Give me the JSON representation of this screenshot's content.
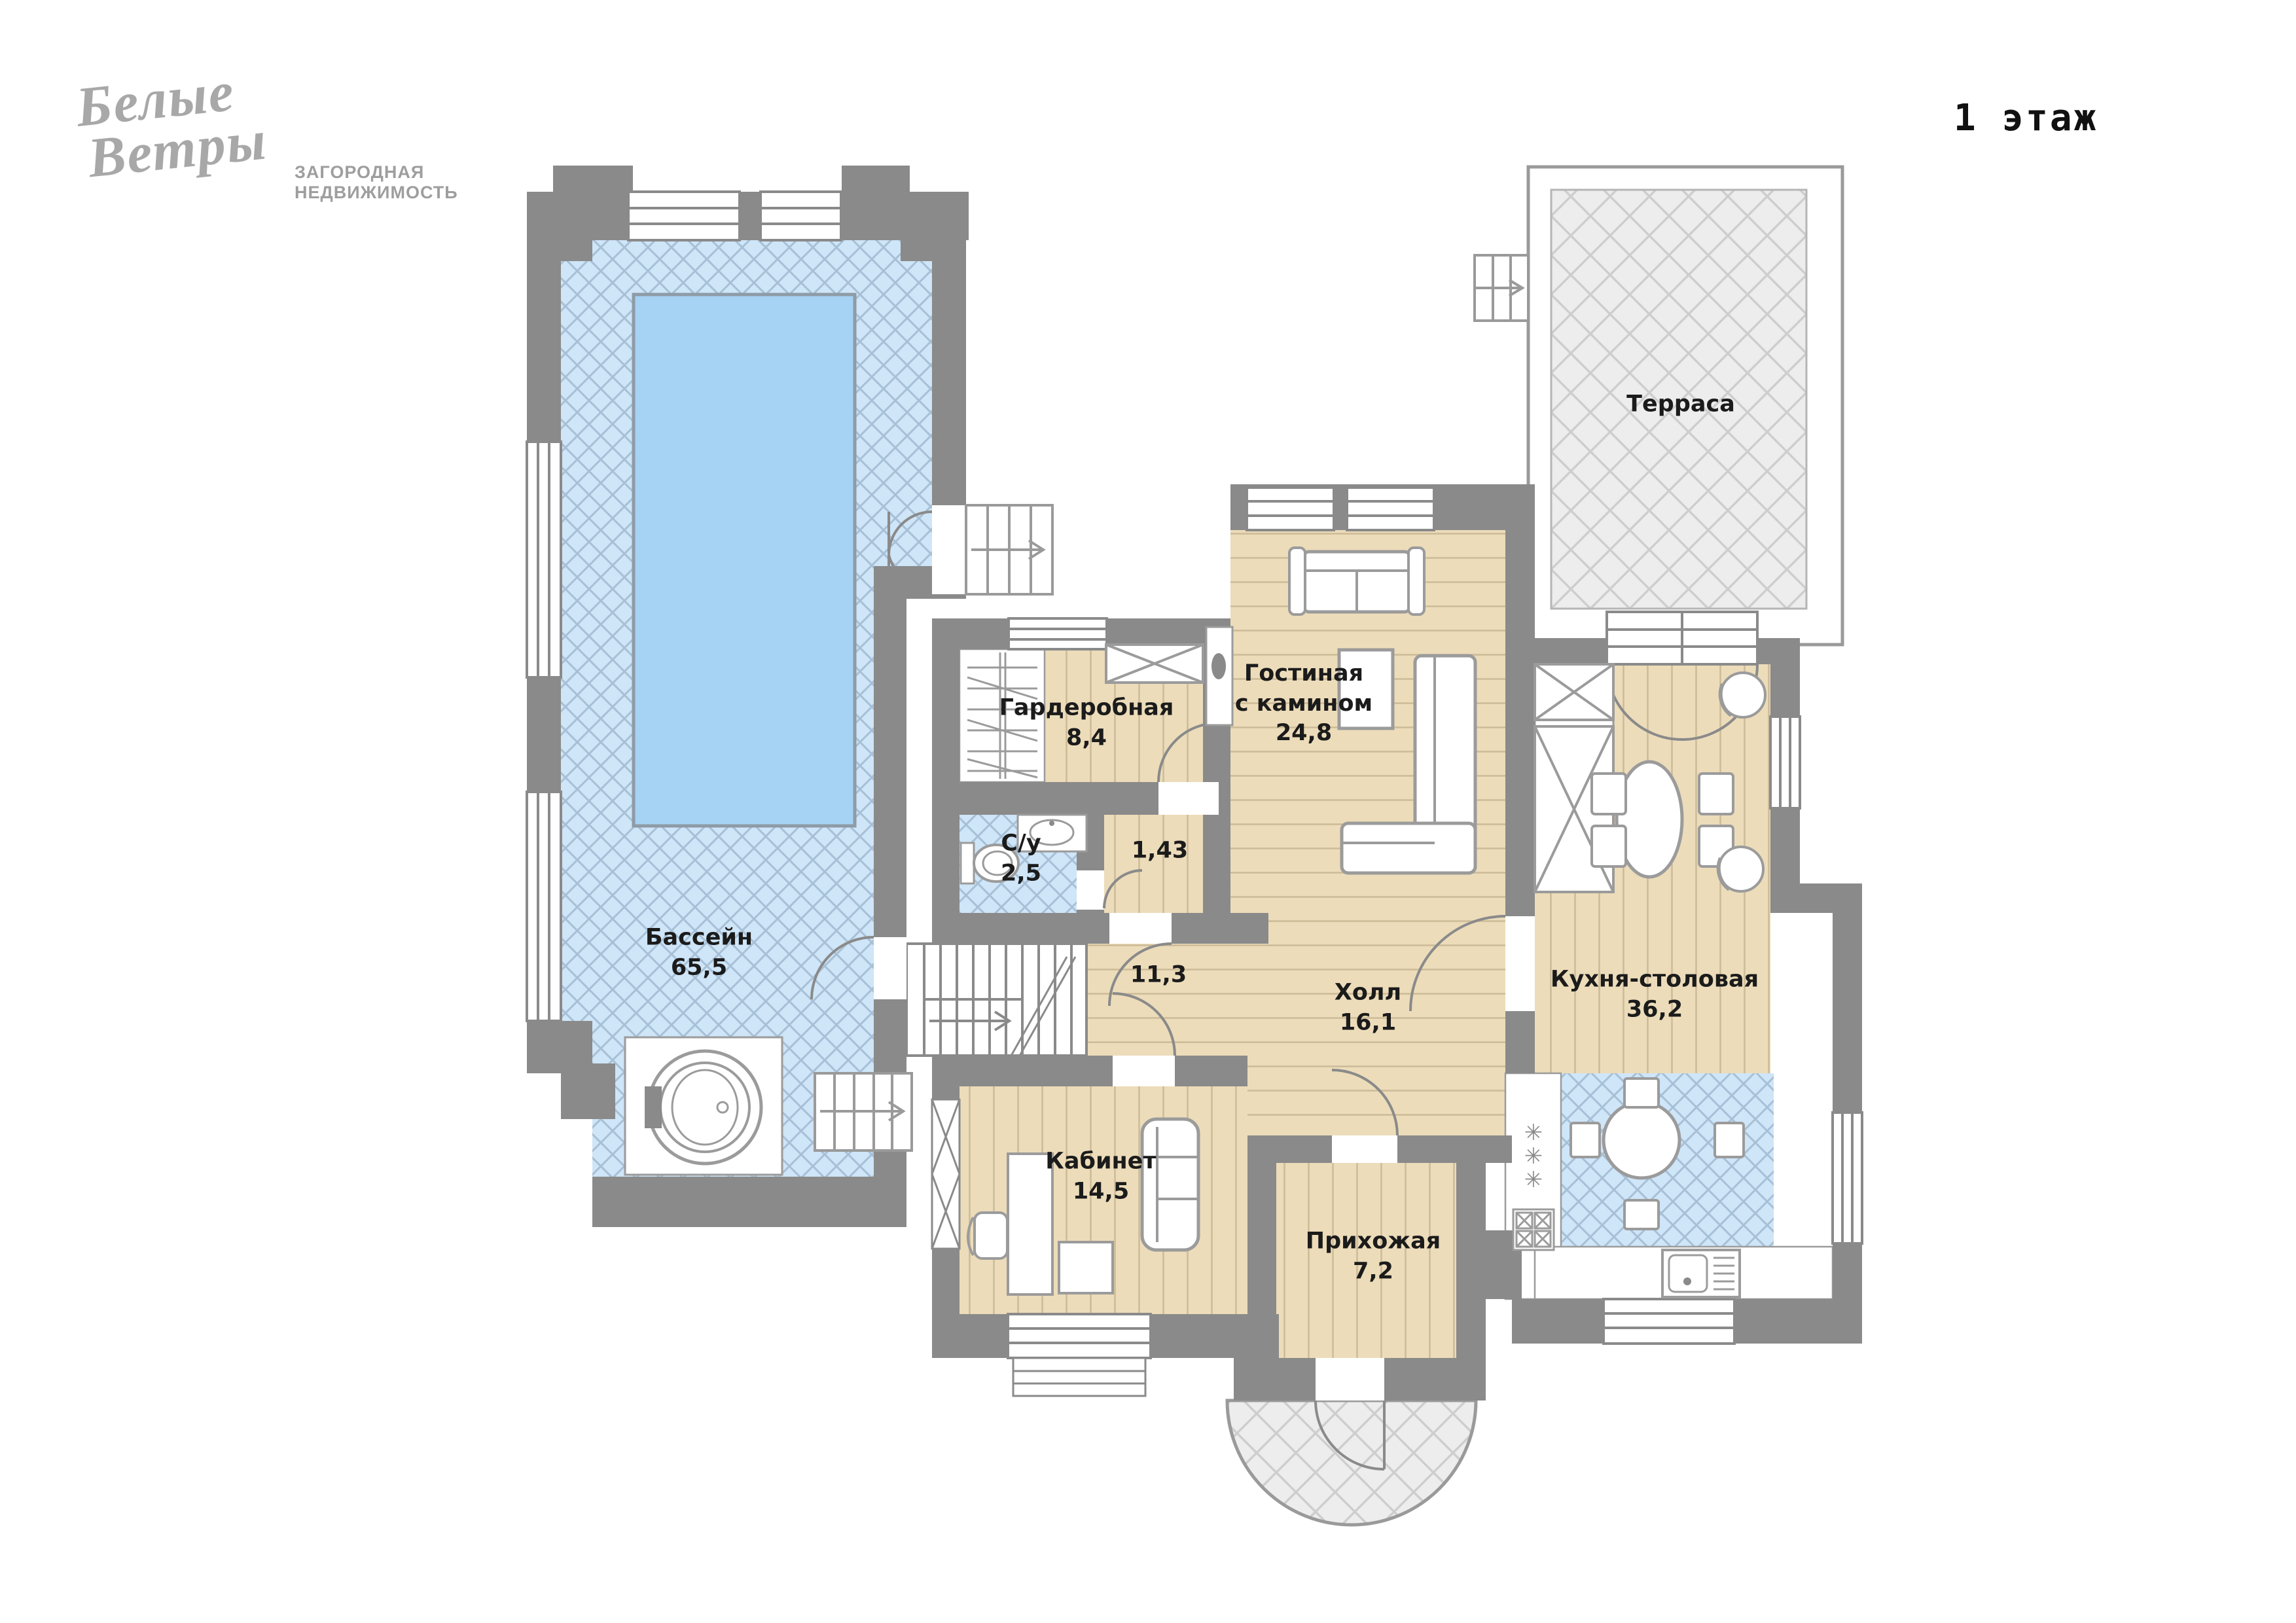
{
  "logo": {
    "line1": "Белые",
    "line2": "Ветры",
    "subtitle_line1": "ЗАГОРОДНАЯ",
    "subtitle_line2": "НЕДВИЖИМОСТЬ"
  },
  "floor": {
    "label": "1 этаж"
  },
  "rooms": {
    "pool": {
      "name": "Бассейн",
      "area": "65,5"
    },
    "wardrobe": {
      "name": "Гардеробная",
      "area": "8,4"
    },
    "bathroom": {
      "name": "С/у",
      "area": "2,5"
    },
    "niche": {
      "area": "1,43"
    },
    "living": {
      "name_line1": "Гостиная",
      "name_line2": "с камином",
      "area": "24,8"
    },
    "hall": {
      "name": "Холл",
      "area": "16,1"
    },
    "stair_hall": {
      "area": "11,3"
    },
    "kitchen": {
      "name": "Кухня-столовая",
      "area": "36,2"
    },
    "study": {
      "name": "Кабинет",
      "area": "14,5"
    },
    "entry": {
      "name": "Прихожая",
      "area": "7,2"
    },
    "terrace": {
      "name": "Терраса"
    }
  },
  "palette": {
    "wall": "#8a8a8a",
    "wood_floor": "#ecdcba",
    "tile_blue": "#cfe5f8",
    "pool_water": "#a6d2f4",
    "terrace_tile": "#ededed"
  }
}
